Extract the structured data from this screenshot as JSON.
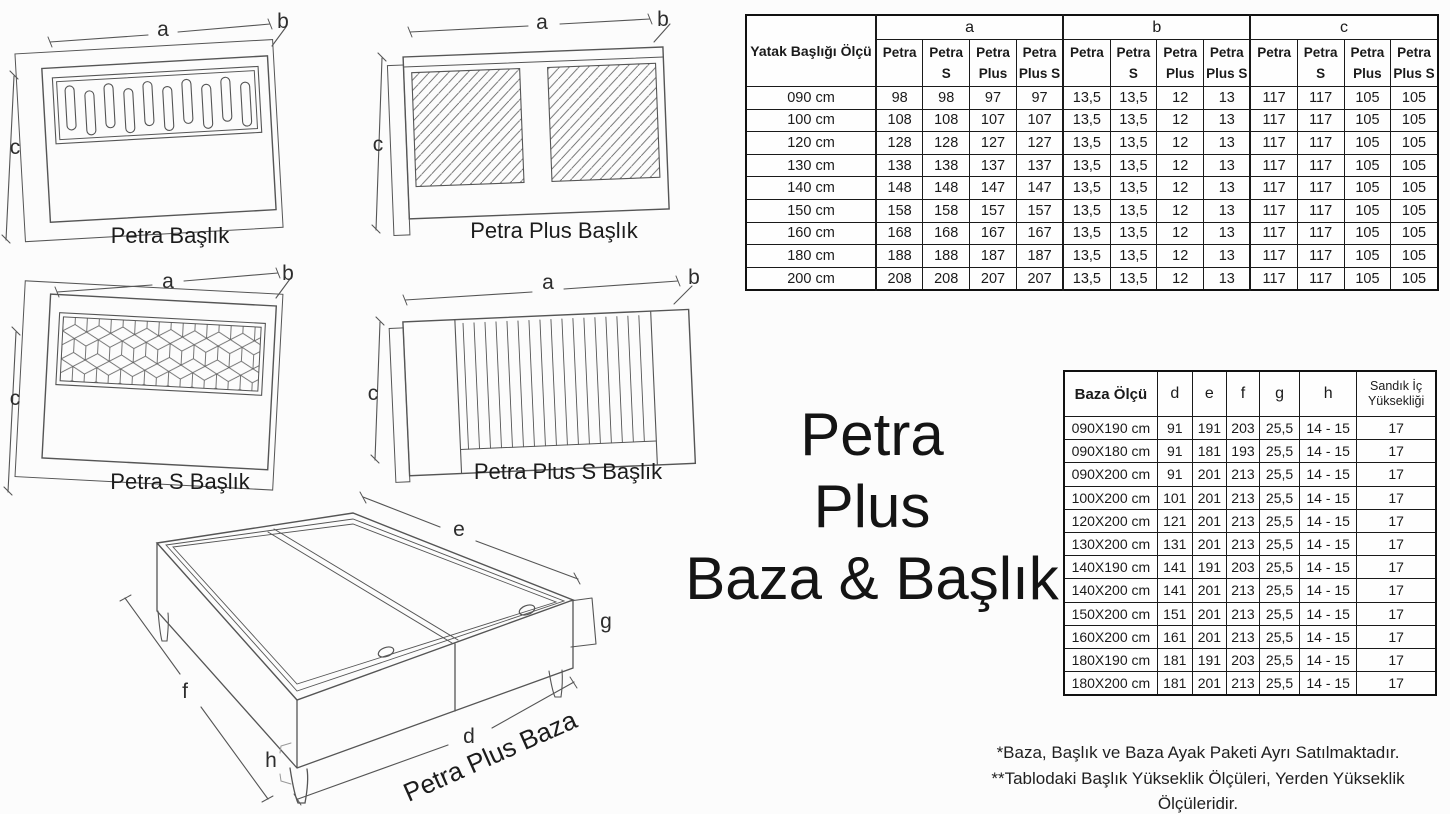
{
  "page": {
    "background": "#fcfcfc"
  },
  "title": {
    "line1": "Petra",
    "line2": "Plus",
    "line3": "Baza & Başlık"
  },
  "dim_labels": {
    "a": "a",
    "b": "b",
    "c": "c",
    "d": "d",
    "e": "e",
    "f": "f",
    "g": "g",
    "h": "h"
  },
  "drawings": {
    "petra": {
      "caption": "Petra Başlık"
    },
    "petra_plus": {
      "caption": "Petra Plus Başlık"
    },
    "petra_s": {
      "caption": "Petra S Başlık"
    },
    "petra_plus_s": {
      "caption": "Petra Plus S Başlık"
    },
    "petra_plus_baza": {
      "caption": "Petra Plus Baza"
    }
  },
  "headboard_table": {
    "corner_header": "Yatak Başlığı Ölçü",
    "groups": [
      "a",
      "b",
      "c"
    ],
    "sub_columns": [
      [
        "Petra",
        ""
      ],
      [
        "Petra",
        "S"
      ],
      [
        "Petra",
        "Plus"
      ],
      [
        "Petra",
        "Plus S"
      ]
    ],
    "rows": [
      {
        "size": "090 cm",
        "values": [
          "98",
          "98",
          "97",
          "97",
          "13,5",
          "13,5",
          "12",
          "13",
          "117",
          "117",
          "105",
          "105"
        ]
      },
      {
        "size": "100 cm",
        "values": [
          "108",
          "108",
          "107",
          "107",
          "13,5",
          "13,5",
          "12",
          "13",
          "117",
          "117",
          "105",
          "105"
        ]
      },
      {
        "size": "120 cm",
        "values": [
          "128",
          "128",
          "127",
          "127",
          "13,5",
          "13,5",
          "12",
          "13",
          "117",
          "117",
          "105",
          "105"
        ]
      },
      {
        "size": "130 cm",
        "values": [
          "138",
          "138",
          "137",
          "137",
          "13,5",
          "13,5",
          "12",
          "13",
          "117",
          "117",
          "105",
          "105"
        ]
      },
      {
        "size": "140 cm",
        "values": [
          "148",
          "148",
          "147",
          "147",
          "13,5",
          "13,5",
          "12",
          "13",
          "117",
          "117",
          "105",
          "105"
        ]
      },
      {
        "size": "150 cm",
        "values": [
          "158",
          "158",
          "157",
          "157",
          "13,5",
          "13,5",
          "12",
          "13",
          "117",
          "117",
          "105",
          "105"
        ]
      },
      {
        "size": "160 cm",
        "values": [
          "168",
          "168",
          "167",
          "167",
          "13,5",
          "13,5",
          "12",
          "13",
          "117",
          "117",
          "105",
          "105"
        ]
      },
      {
        "size": "180 cm",
        "values": [
          "188",
          "188",
          "187",
          "187",
          "13,5",
          "13,5",
          "12",
          "13",
          "117",
          "117",
          "105",
          "105"
        ]
      },
      {
        "size": "200 cm",
        "values": [
          "208",
          "208",
          "207",
          "207",
          "13,5",
          "13,5",
          "12",
          "13",
          "117",
          "117",
          "105",
          "105"
        ]
      }
    ]
  },
  "baza_table": {
    "headers": [
      "Baza Ölçü",
      "d",
      "e",
      "f",
      "g",
      "h",
      "Sandık İç Yüksekliği"
    ],
    "rows": [
      [
        "090X190 cm",
        "91",
        "191",
        "203",
        "25,5",
        "14 - 15",
        "17"
      ],
      [
        "090X180 cm",
        "91",
        "181",
        "193",
        "25,5",
        "14 - 15",
        "17"
      ],
      [
        "090X200 cm",
        "91",
        "201",
        "213",
        "25,5",
        "14 - 15",
        "17"
      ],
      [
        "100X200 cm",
        "101",
        "201",
        "213",
        "25,5",
        "14 - 15",
        "17"
      ],
      [
        "120X200 cm",
        "121",
        "201",
        "213",
        "25,5",
        "14 - 15",
        "17"
      ],
      [
        "130X200 cm",
        "131",
        "201",
        "213",
        "25,5",
        "14 - 15",
        "17"
      ],
      [
        "140X190 cm",
        "141",
        "191",
        "203",
        "25,5",
        "14 - 15",
        "17"
      ],
      [
        "140X200 cm",
        "141",
        "201",
        "213",
        "25,5",
        "14 - 15",
        "17"
      ],
      [
        "150X200 cm",
        "151",
        "201",
        "213",
        "25,5",
        "14 - 15",
        "17"
      ],
      [
        "160X200 cm",
        "161",
        "201",
        "213",
        "25,5",
        "14 - 15",
        "17"
      ],
      [
        "180X190 cm",
        "181",
        "191",
        "203",
        "25,5",
        "14 - 15",
        "17"
      ],
      [
        "180X200 cm",
        "181",
        "201",
        "213",
        "25,5",
        "14 - 15",
        "17"
      ]
    ]
  },
  "notes": [
    "*Baza, Başlık ve Baza Ayak Paketi Ayrı Satılmaktadır.",
    "**Tablodaki Başlık Yükseklik Ölçüleri, Yerden Yükseklik Ölçüleridir.",
    "***Ayak Yükseklik Ölçüleri Seçime Göre Değişiklik Gösterebilir."
  ]
}
